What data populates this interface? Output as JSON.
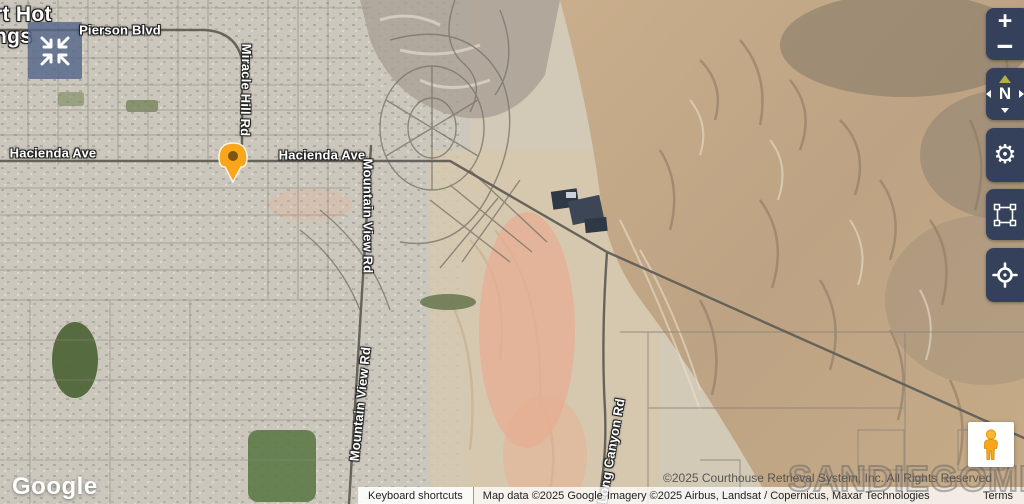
{
  "city_label": {
    "line1": "rt Hot",
    "line2": "ngs"
  },
  "roads": {
    "pierson": "Pierson Blvd",
    "miracle_hill": "Miracle Hill Rd",
    "hacienda_w": "Hacienda Ave",
    "hacienda_e": "Hacienda Ave",
    "mountain_view_n": "Mountain View Rd",
    "mountain_view_s": "Mountain View Rd",
    "long_canyon": "Long Canyon Rd"
  },
  "watermark": {
    "copyright": "©2025 Courthouse Retrieval System, Inc. All Rights Reserved",
    "mls": "SANDIEGOMLS"
  },
  "attribution": {
    "google": "Google",
    "keyboard_shortcuts": "Keyboard shortcuts",
    "map_data": "Map data ©2025 Google",
    "imagery": "Imagery ©2025 Airbus, Landsat / Copernicus, Maxar Technologies",
    "terms": "Terms"
  },
  "controls": {
    "zoom_in": "+",
    "zoom_out": "−",
    "compass": "N",
    "gear_glyph": "⚙"
  },
  "colors": {
    "control_panel": "#35415A",
    "marker_fill": "#F9A61A",
    "compass_needle": "#B5AE45",
    "mls_logo_bg": "rgba(86,103,138,0.82)"
  }
}
